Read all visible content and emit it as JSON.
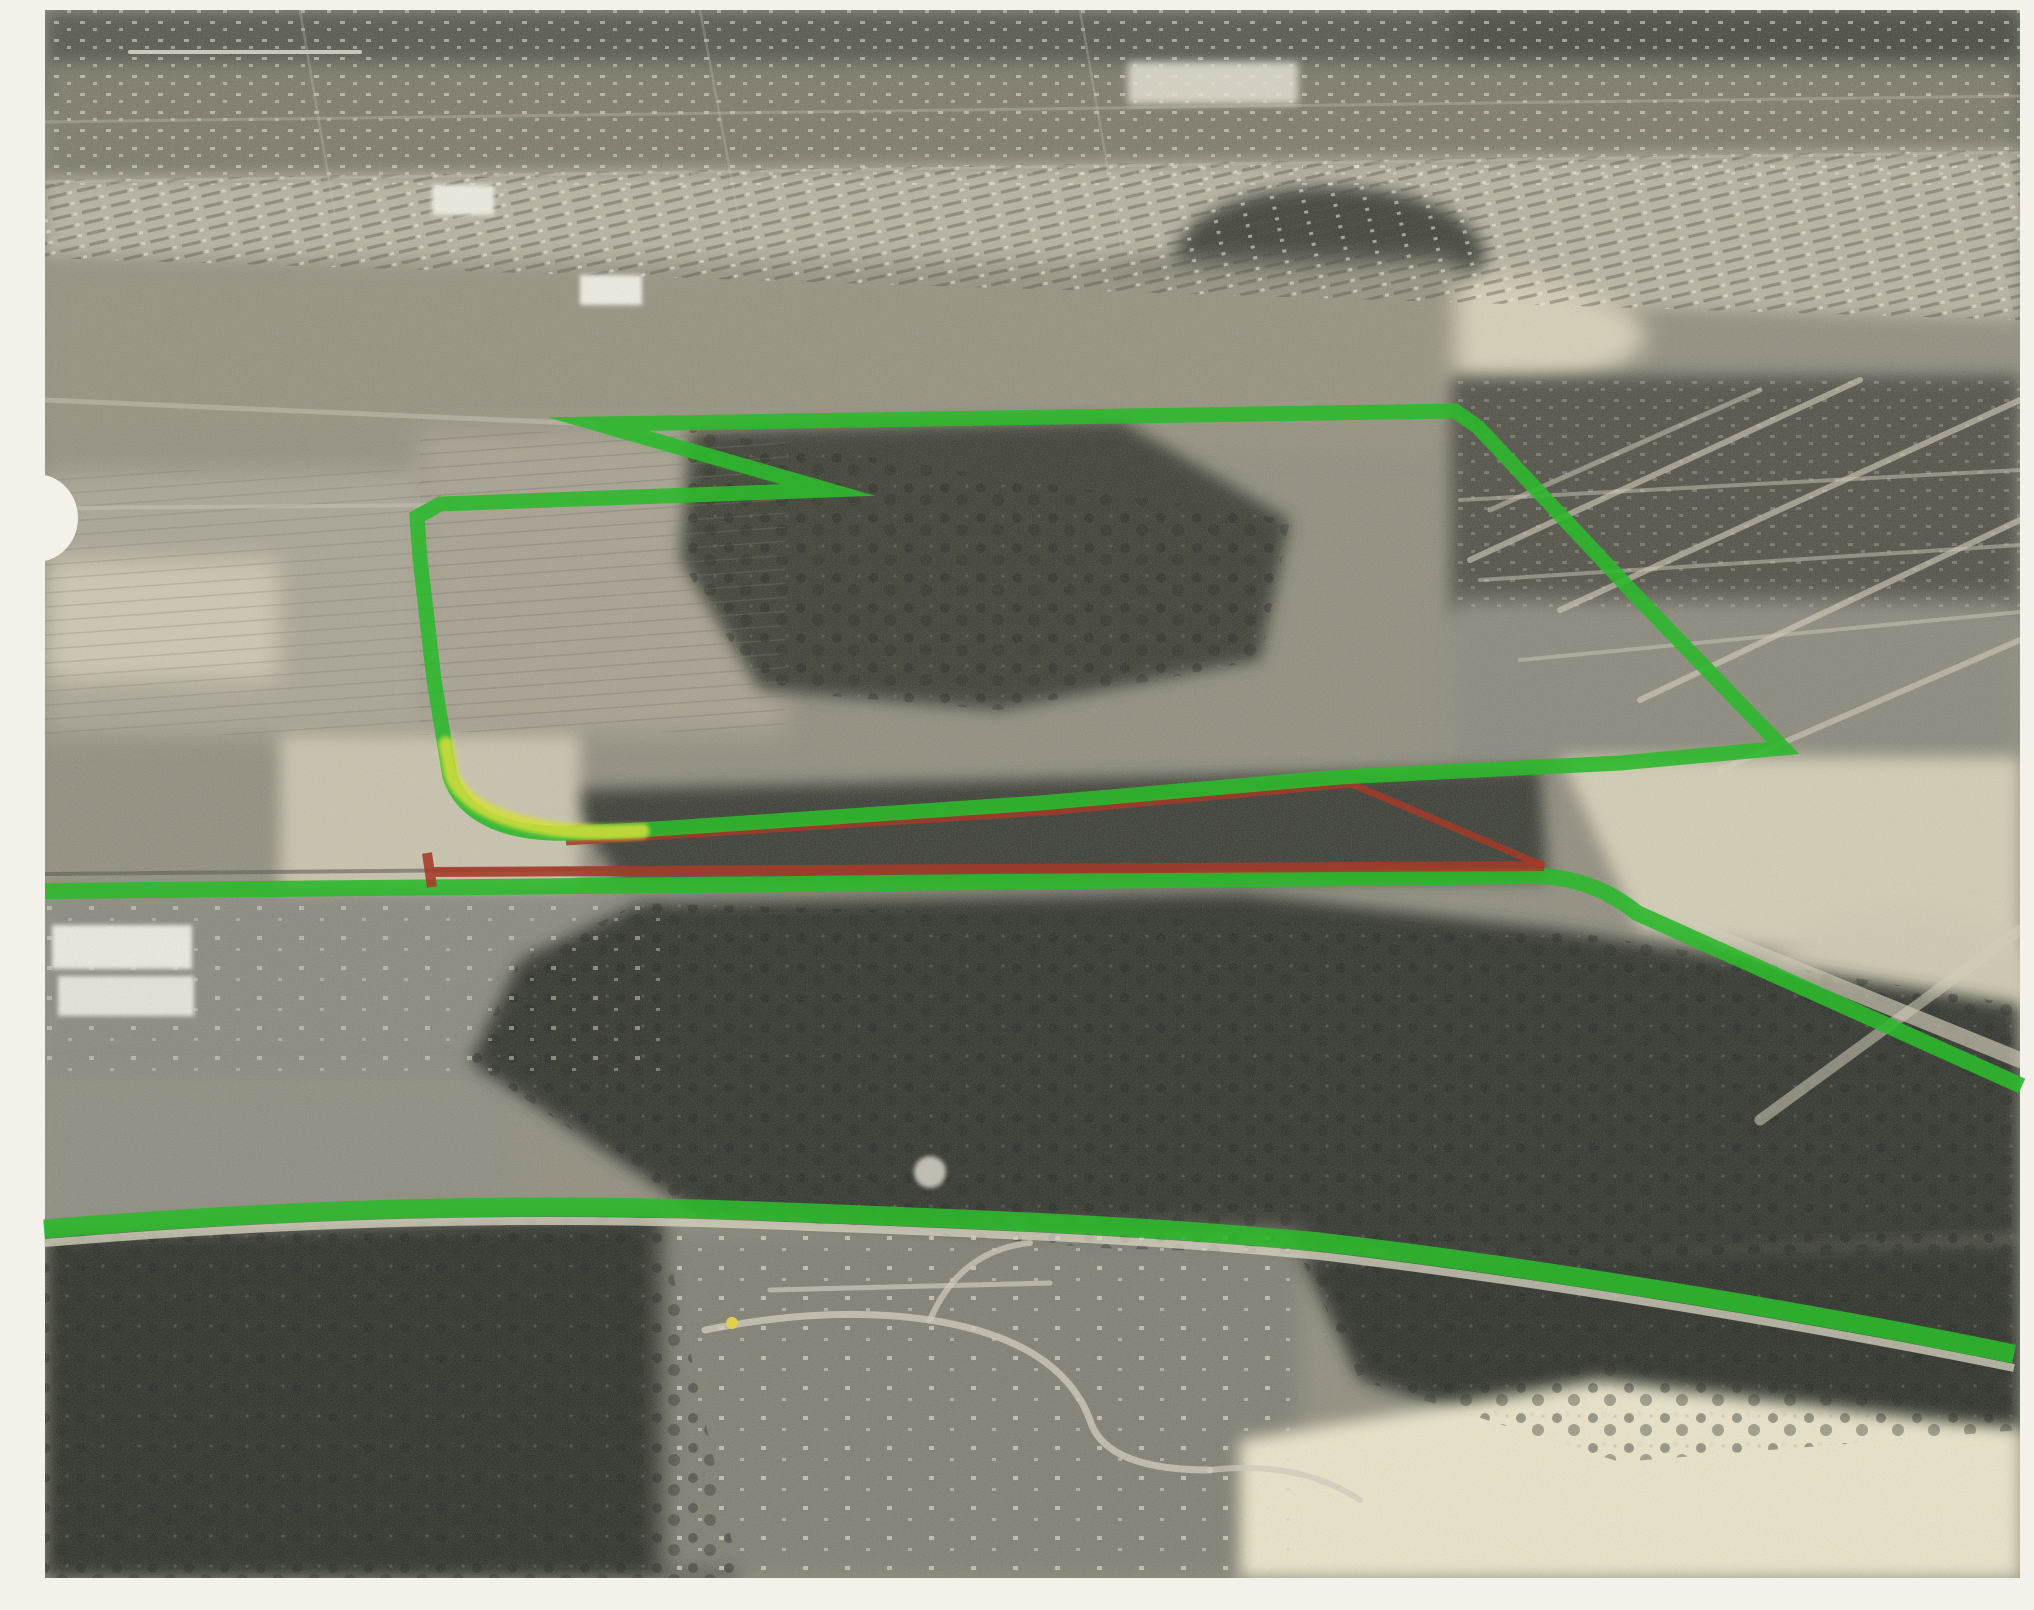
{
  "scene": {
    "title": "Scanned black-and-white oblique aerial photograph with hand-drawn marker route annotations",
    "description": "Monochrome aerial photo of a town: dense housing grid at top, open fields and a large wooded tract mid-frame, a broad dark forest below center, and winding subdivision roads near the bottom. A green marker outlines a site boundary with a notched hook at its top-left; a yellow-tinged bend sits at the boundary's lower-left corner. A dark-red marker traces an alternate alignment wedge beside the boundary. Two more long green marker lines follow roads: one across mid-frame descending to the right edge, one sweeping arc across the lower third.",
    "margin_color": "#f3f1ea",
    "photo_frame": {
      "left": 45,
      "top": 10,
      "right": 2020,
      "bottom": 1578
    }
  },
  "annotations": {
    "colors": {
      "green": "#2db82d",
      "green_bright": "#3dc72f",
      "yellow": "#d5de3c",
      "red": "#a53a28",
      "road_white": "#dcd7c5",
      "road_dark": "#55544a"
    },
    "site_boundary": {
      "d": "M 598 424 L 1455 411 L 1478 427 L 1640 600 L 1783 748 L 1620 763 L 1340 777 L 1040 803 L 760 822 L 640 830 L 575 833 C 500 836 462 812 450 777 L 434 680 L 420 558 L 417 517 L 440 504 L 828 490 Z",
      "width": 15
    },
    "boundary_smear": {
      "d": "M 615 425 L 833 491 L 822 498 L 604 433 Z"
    },
    "yellow_bend": {
      "d": "M 642 831 C 545 837 470 818 452 776 L 446 744",
      "width": 15
    },
    "red_route": {
      "d": "M 427 853 L 432 887 M 429 872 L 1544 866",
      "width": 10
    },
    "red_route_diagonal": {
      "d": "M 566 842 L 1046 812 L 1352 784 L 1544 866",
      "width": 7
    },
    "middle_route": {
      "d": "M 45 891 L 800 884 L 1538 876 Q 1594 878 1637 913 L 2022 1086",
      "width": 16
    },
    "bottom_route": {
      "d": "M 44 1229 C 300 1208 520 1202 760 1211 C 1000 1220 1150 1226 1320 1242 C 1500 1263 1780 1306 2014 1354",
      "width": 19
    }
  }
}
